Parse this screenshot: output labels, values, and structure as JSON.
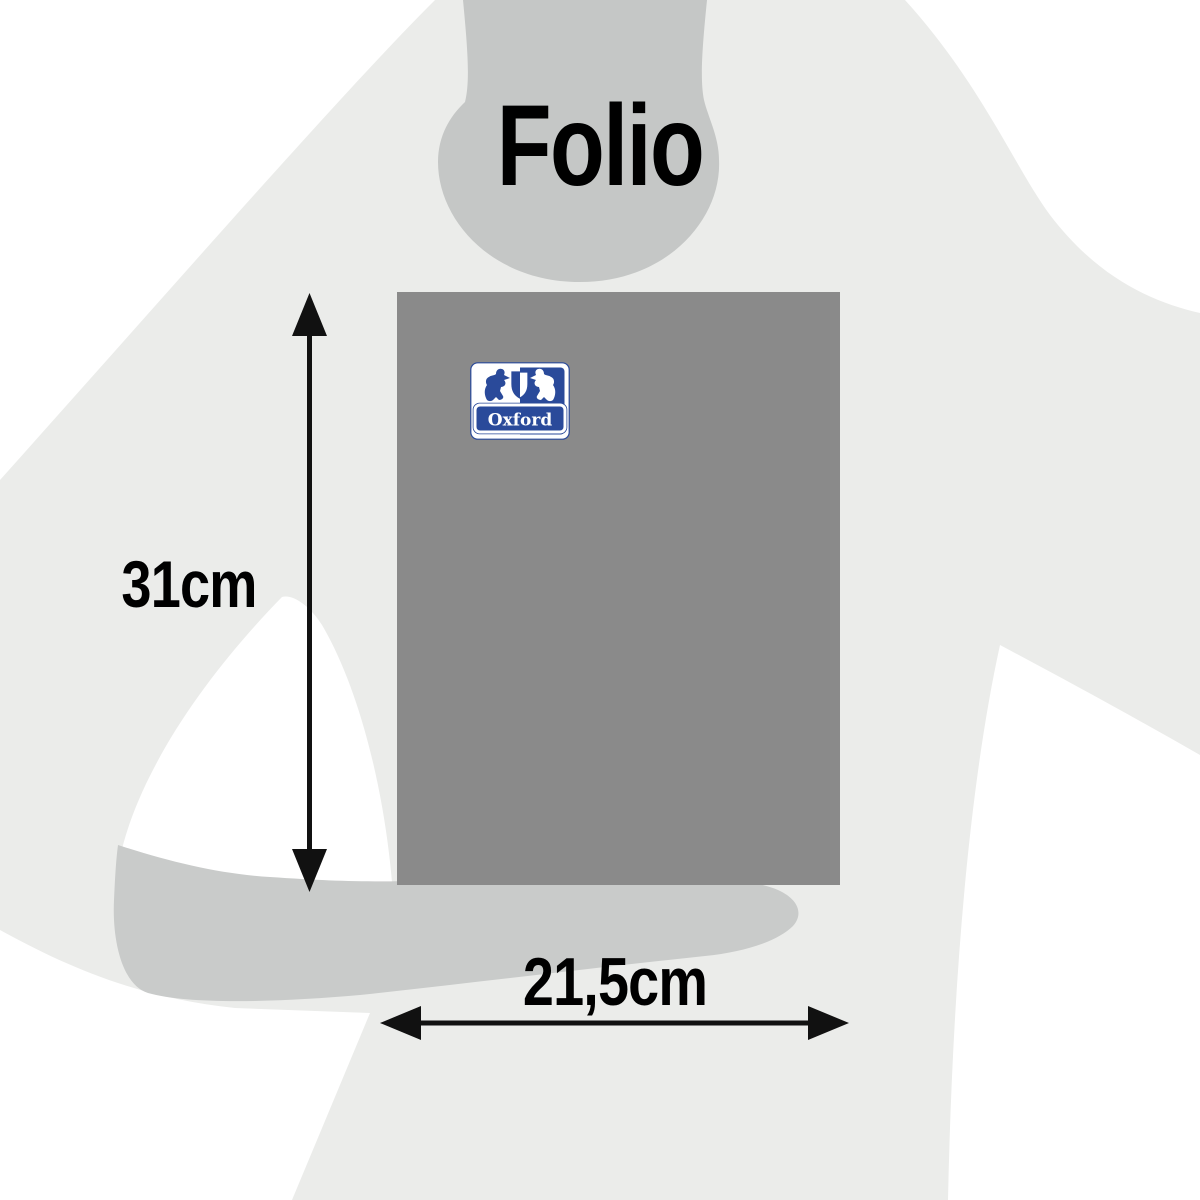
{
  "title": "Folio",
  "dimensions": {
    "height": "31cm",
    "width": "21,5cm"
  },
  "notebook": {
    "brand": "Oxford"
  },
  "colors": {
    "background": "#ffffff",
    "silhouette": "#ebecea",
    "head": "#c5c7c6",
    "forearm": "#c9cbca",
    "notebook": "#8a8a8a",
    "logo_blue": "#2a4a9a",
    "logo_white": "#ffffff",
    "arrow": "#111111",
    "text": "#000000"
  }
}
